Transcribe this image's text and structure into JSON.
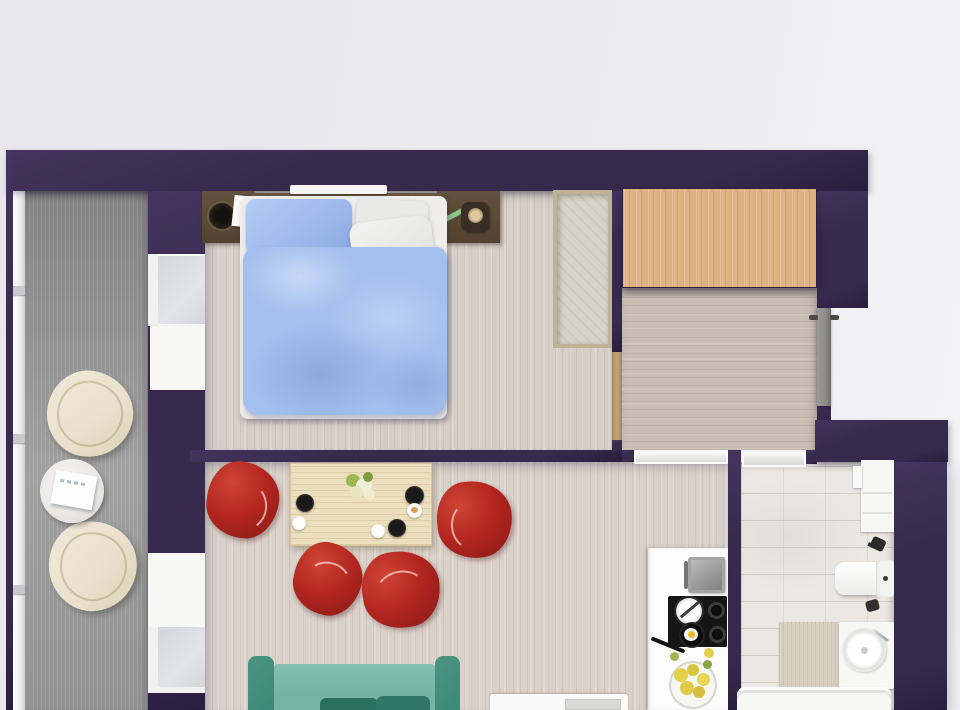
{
  "meta": {
    "content_type": "3d-floor-plan-render",
    "view": "top-down",
    "visible_text": []
  },
  "colors": {
    "background_left": "#e6e6eb",
    "background_right": "#f4f4f7",
    "wall": "#382a4d",
    "wall_edge": "#44345e",
    "wall_shadow": "#2a1e3e",
    "balcony_floor": "#9a9a9a",
    "wood_floor": "#d7cec7",
    "wood_floor_living": "#dad1ca",
    "hallway_floor": "#c7bdb2",
    "wardrobe": "#deb284",
    "headboard": "#5a4939",
    "closet_frame": "#bfb296",
    "closet_inside": "#d8d3c9",
    "mattress": "#efedea",
    "pillow_blue": "#9db9ec",
    "pillow_white": "#e9e9e7",
    "duvet_blue": "#a4c0ef",
    "red_chair": "#b2261f",
    "red_chair_deep": "#8c1a16",
    "table_wood": "#ebdfbd",
    "sofa_teal": "#76b5a5",
    "sofa_arm": "#3c8976",
    "sofa_cushion": "#2b6f61",
    "cream_chair": "#e9e1cc",
    "cream_chair_edge": "#cfc3a6",
    "white": "#f7f7f6",
    "glass": "#d5d6da",
    "door_gray": "#8d8c8a",
    "frame_tan": "#c5a478",
    "marble": "#ebe7e2",
    "mat": "#d8d1c2",
    "counter": "#fcfcfc",
    "cooktop": "#151515",
    "yolk": "#eab62a",
    "flower_yellow": "#e4cf49",
    "leaf_green": "#9cb84e",
    "pen_green": "#8cc88c"
  },
  "scene": {
    "rooms": [
      {
        "name": "balcony",
        "floor": "gray-decking",
        "furniture": [
          "cream-armchair",
          "cream-armchair",
          "round-side-table",
          "magazine-stack"
        ]
      },
      {
        "name": "bedroom",
        "floor": "light-wood",
        "furniture": [
          "double-bed-blue-duvet",
          "headboard-unit",
          "nightstand-left",
          "nightstand-right",
          "alarm-clock",
          "notepad",
          "green-pen",
          "bedside-lamp",
          "built-in-closet"
        ]
      },
      {
        "name": "entry-hall",
        "floor": "light-wood",
        "furniture": [
          "wardrobe",
          "entry-door"
        ]
      },
      {
        "name": "living-room",
        "floor": "light-wood",
        "furniture": [
          "dining-table",
          "red-armchair",
          "red-armchair",
          "red-armchair",
          "red-armchair",
          "flower-bouquet",
          "dark-plate",
          "dark-plate",
          "dark-plate",
          "white-saucer",
          "pastry-plate",
          "white-cup",
          "teal-sofa",
          "media-console"
        ]
      },
      {
        "name": "kitchen",
        "floor": "light-wood",
        "furniture": [
          "counter",
          "sink-unit",
          "cooktop",
          "saucepan",
          "frying-pan-with-egg",
          "burner",
          "burner",
          "yellow-flower-bowl"
        ]
      },
      {
        "name": "bathroom",
        "floor": "marble-tile",
        "furniture": [
          "wall-cabinet",
          "toilet",
          "vessel-sink-vanity",
          "chrome-faucet",
          "black-fixture",
          "black-fixture",
          "bath-mat",
          "bathtub"
        ]
      }
    ],
    "windows": [
      "balcony-glazing-left",
      "bedroom-balcony-window",
      "living-room-balcony-window"
    ],
    "doors": [
      "entry-door-gray",
      "bedroom-door-opening",
      "bathroom-door-threshold",
      "kitchen-opening-threshold"
    ]
  }
}
